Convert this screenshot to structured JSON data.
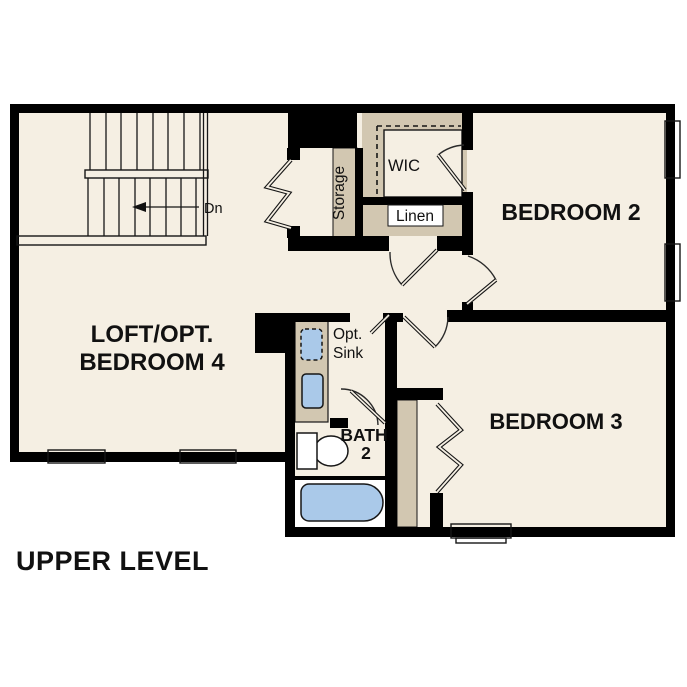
{
  "plan_title": "UPPER LEVEL",
  "colors": {
    "background": "#ffffff",
    "floor": "#f5efe3",
    "cabinetry": "#d2c7b1",
    "fixture_blue": "#aac9e9",
    "wall": "#000000",
    "label": "#111111"
  },
  "rooms": {
    "loft": {
      "label_line1": "LOFT/OPT.",
      "label_line2": "BEDROOM 4"
    },
    "bedroom2": {
      "label": "BEDROOM 2"
    },
    "bedroom3": {
      "label": "BEDROOM 3"
    },
    "bath2": {
      "label_line1": "BATH",
      "label_line2": "2"
    },
    "wic": {
      "label": "WIC"
    },
    "linen": {
      "label": "Linen"
    },
    "storage": {
      "label": "Storage"
    }
  },
  "annotations": {
    "optional_sink": {
      "line1": "Opt.",
      "line2": "Sink"
    },
    "stair_direction": "Dn"
  }
}
